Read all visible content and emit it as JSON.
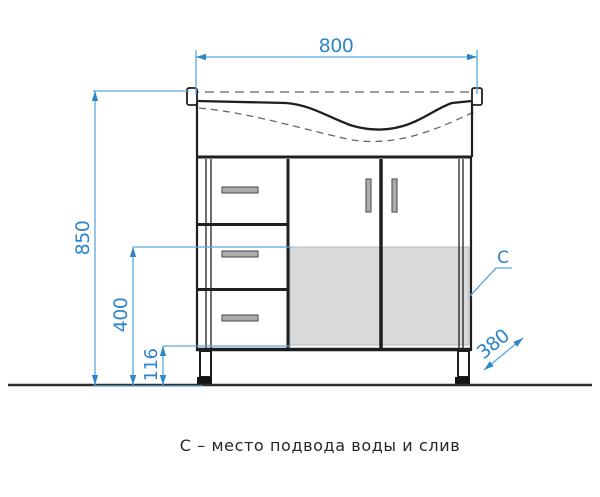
{
  "drawing": {
    "caption": "С – место подвода воды и слив",
    "zone_label": "C",
    "dimensions": {
      "width_mm": "800",
      "height_mm": "850",
      "zone_height_mm": "400",
      "plinth_height_mm": "116",
      "depth_mm": "380"
    },
    "colors": {
      "dimension_blue": "#2e86c8",
      "dimension_line_blue": "#5ea7da",
      "line_black": "#1f1f1f",
      "zone_fill": "#dadada"
    }
  }
}
